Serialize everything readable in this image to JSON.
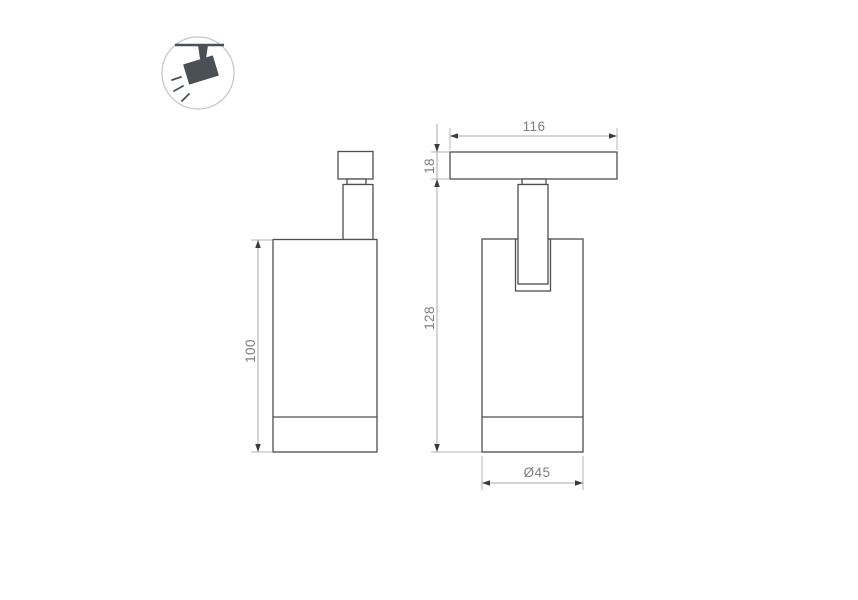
{
  "icon": {
    "name": "ceiling-track-spotlight-icon",
    "color": "#4A5056",
    "ring_color": "#C6C6C6"
  },
  "drawing": {
    "colors": {
      "outline": "#4F4F4F",
      "dimension_line": "#A9A9A9",
      "arrow": "#3C3C3C",
      "label": "#7E7E7E"
    },
    "side_view": {
      "height": "100"
    },
    "front_view": {
      "track_width": "116",
      "track_height": "18",
      "overall_height": "128",
      "diameter": "Ø45"
    }
  }
}
